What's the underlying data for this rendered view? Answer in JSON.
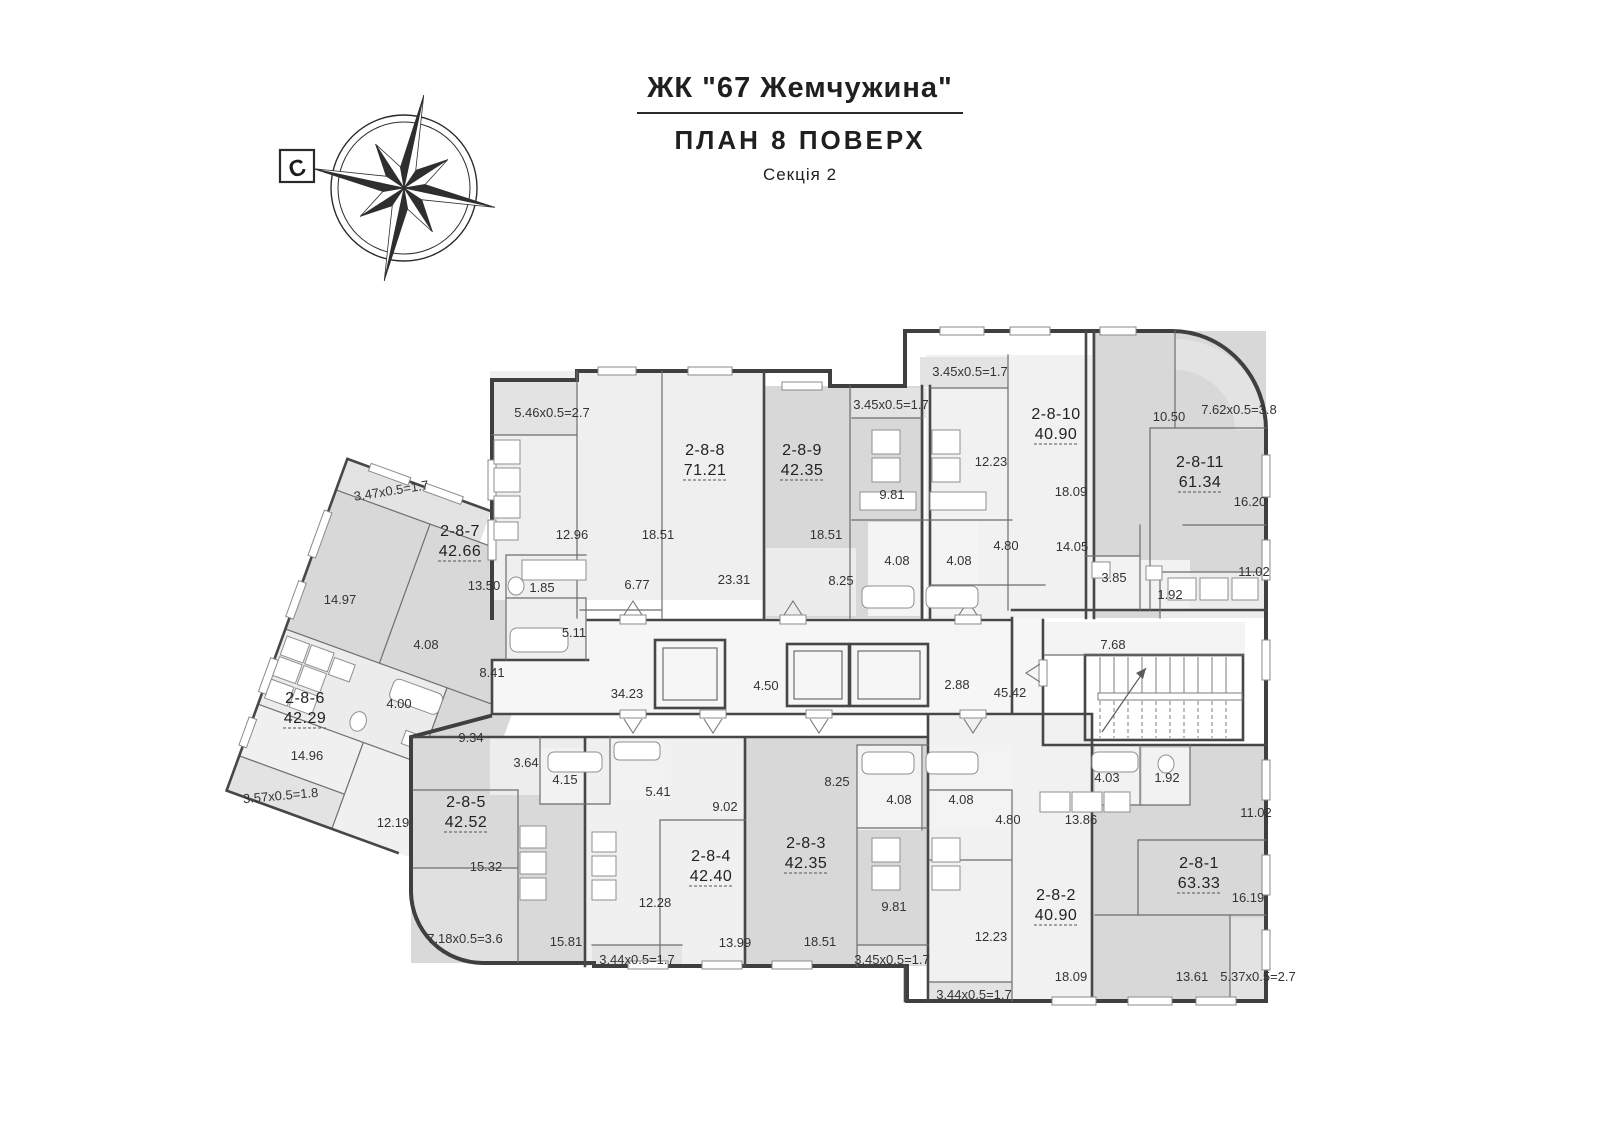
{
  "title": {
    "complex": "ЖК \"67 Жемчужина\"",
    "plan": "ПЛАН 8 ПОВЕРХ",
    "section": "Секція 2"
  },
  "compass": {
    "north": "С"
  },
  "plan": {
    "apartments": [
      {
        "id": "2-8-1",
        "area": "63.33",
        "x": 1199,
        "y": 868
      },
      {
        "id": "2-8-2",
        "area": "40.90",
        "x": 1056,
        "y": 900
      },
      {
        "id": "2-8-3",
        "area": "42.35",
        "x": 806,
        "y": 848
      },
      {
        "id": "2-8-4",
        "area": "42.40",
        "x": 711,
        "y": 861
      },
      {
        "id": "2-8-5",
        "area": "42.52",
        "x": 466,
        "y": 807
      },
      {
        "id": "2-8-6",
        "area": "42.29",
        "x": 305,
        "y": 703
      },
      {
        "id": "2-8-7",
        "area": "42.66",
        "x": 460,
        "y": 536
      },
      {
        "id": "2-8-8",
        "area": "71.21",
        "x": 705,
        "y": 455
      },
      {
        "id": "2-8-9",
        "area": "42.35",
        "x": 802,
        "y": 455
      },
      {
        "id": "2-8-10",
        "area": "40.90",
        "x": 1056,
        "y": 419
      },
      {
        "id": "2-8-11",
        "area": "61.34",
        "x": 1200,
        "y": 467
      }
    ],
    "dim_labels": [
      {
        "t": "5.46x0.5=2.7",
        "x": 552,
        "y": 417
      },
      {
        "t": "12.96",
        "x": 572,
        "y": 539
      },
      {
        "t": "18.51",
        "x": 658,
        "y": 539
      },
      {
        "t": "23.31",
        "x": 734,
        "y": 584
      },
      {
        "t": "6.77",
        "x": 637,
        "y": 589
      },
      {
        "t": "1.85",
        "x": 542,
        "y": 592
      },
      {
        "t": "5.11",
        "x": 574,
        "y": 637
      },
      {
        "t": "13.50",
        "x": 484,
        "y": 590
      },
      {
        "t": "14.97",
        "x": 340,
        "y": 604
      },
      {
        "t": "3.47x0.5=1.7",
        "x": 392,
        "y": 495,
        "r": -9
      },
      {
        "t": "4.08",
        "x": 426,
        "y": 649
      },
      {
        "t": "8.41",
        "x": 492,
        "y": 677
      },
      {
        "t": "4.00",
        "x": 399,
        "y": 708
      },
      {
        "t": "14.96",
        "x": 307,
        "y": 760
      },
      {
        "t": "3.57x0.5=1.8",
        "x": 281,
        "y": 800,
        "r": -5
      },
      {
        "t": "12.19",
        "x": 393,
        "y": 827
      },
      {
        "t": "9.34",
        "x": 471,
        "y": 742
      },
      {
        "t": "18.51",
        "x": 826,
        "y": 539
      },
      {
        "t": "8.25",
        "x": 841,
        "y": 585
      },
      {
        "t": "3.45x0.5=1.7",
        "x": 891,
        "y": 409
      },
      {
        "t": "9.81",
        "x": 892,
        "y": 499
      },
      {
        "t": "4.08",
        "x": 897,
        "y": 565
      },
      {
        "t": "4.08",
        "x": 959,
        "y": 565
      },
      {
        "t": "4.80",
        "x": 1006,
        "y": 550
      },
      {
        "t": "12.23",
        "x": 991,
        "y": 466
      },
      {
        "t": "3.45x0.5=1.7",
        "x": 970,
        "y": 376
      },
      {
        "t": "18.09",
        "x": 1071,
        "y": 496
      },
      {
        "t": "10.50",
        "x": 1169,
        "y": 421
      },
      {
        "t": "7.62x0.5=3.8",
        "x": 1239,
        "y": 414
      },
      {
        "t": "16.20",
        "x": 1250,
        "y": 506
      },
      {
        "t": "14.05",
        "x": 1072,
        "y": 551
      },
      {
        "t": "3.85",
        "x": 1114,
        "y": 582
      },
      {
        "t": "1.92",
        "x": 1170,
        "y": 599
      },
      {
        "t": "11.02",
        "x": 1254,
        "y": 576
      },
      {
        "t": "34.23",
        "x": 627,
        "y": 698
      },
      {
        "t": "4.50",
        "x": 766,
        "y": 690
      },
      {
        "t": "2.88",
        "x": 957,
        "y": 689
      },
      {
        "t": "45.42",
        "x": 1010,
        "y": 697
      },
      {
        "t": "7.68",
        "x": 1113,
        "y": 649
      },
      {
        "t": "3.64",
        "x": 526,
        "y": 767
      },
      {
        "t": "4.15",
        "x": 565,
        "y": 784
      },
      {
        "t": "5.41",
        "x": 658,
        "y": 796
      },
      {
        "t": "15.32",
        "x": 486,
        "y": 871
      },
      {
        "t": "7.18x0.5=3.6",
        "x": 465,
        "y": 943
      },
      {
        "t": "15.81",
        "x": 566,
        "y": 946
      },
      {
        "t": "3.44x0.5=1.7",
        "x": 637,
        "y": 964
      },
      {
        "t": "12.28",
        "x": 655,
        "y": 907
      },
      {
        "t": "13.99",
        "x": 735,
        "y": 947
      },
      {
        "t": "9.02",
        "x": 725,
        "y": 811
      },
      {
        "t": "8.25",
        "x": 837,
        "y": 786
      },
      {
        "t": "18.51",
        "x": 820,
        "y": 946
      },
      {
        "t": "4.08",
        "x": 899,
        "y": 804
      },
      {
        "t": "4.08",
        "x": 961,
        "y": 804
      },
      {
        "t": "9.81",
        "x": 894,
        "y": 911
      },
      {
        "t": "3.45x0.5=1.7",
        "x": 892,
        "y": 964
      },
      {
        "t": "4.80",
        "x": 1008,
        "y": 824
      },
      {
        "t": "12.23",
        "x": 991,
        "y": 941
      },
      {
        "t": "18.09",
        "x": 1071,
        "y": 981
      },
      {
        "t": "3.44x0.5=1.7",
        "x": 974,
        "y": 999
      },
      {
        "t": "13.86",
        "x": 1081,
        "y": 824
      },
      {
        "t": "4.03",
        "x": 1107,
        "y": 782
      },
      {
        "t": "1.92",
        "x": 1167,
        "y": 782
      },
      {
        "t": "11.02",
        "x": 1256,
        "y": 817
      },
      {
        "t": "16.19",
        "x": 1248,
        "y": 902
      },
      {
        "t": "13.61",
        "x": 1192,
        "y": 981
      },
      {
        "t": "5.37x0.5=2.7",
        "x": 1258,
        "y": 981
      }
    ]
  }
}
